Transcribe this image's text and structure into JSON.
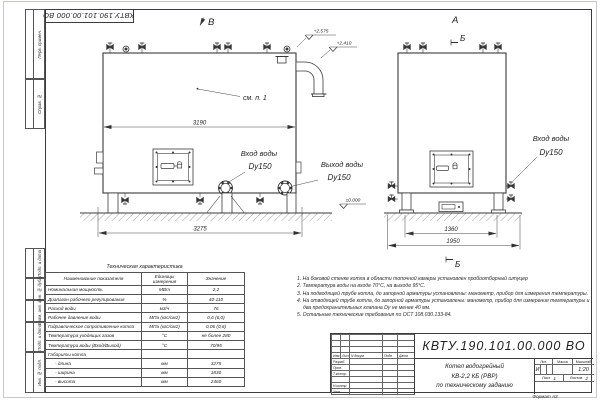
{
  "frame": {
    "top_stamp": "КВТУ.190.101.00.000 ВО",
    "side_labels": [
      "Перв. примен.",
      "Справ. №",
      "Подп. и дата",
      "Инв. № дубл.",
      "Взам. инв. №",
      "Подп. и дата",
      "Инв. № подл."
    ]
  },
  "drawing": {
    "view_b_label": "В",
    "view_a_label": "А",
    "section_label": "Б",
    "callout_see_note": "см. п. 1",
    "dim_3190": "3190",
    "dim_3275": "3275",
    "dim_1360": "1360",
    "dim_1950": "1950",
    "elev_2575": "+2.575",
    "elev_2410": "+2.410",
    "elev_0": "±0.000",
    "inlet_front_label": "Вход воды",
    "inlet_front_size": "Dy150",
    "outlet_front_label": "Выход воды",
    "outlet_front_size": "Dy150",
    "inlet_side_label": "Вход воды",
    "inlet_side_size": "Dy150"
  },
  "tech_table": {
    "title": "Техническая характеристика",
    "headers": [
      "Наименование показателя",
      "Единицы измерения",
      "Значение"
    ],
    "rows": [
      [
        "Номинальная мощность",
        "МВт",
        "2,2"
      ],
      [
        "Диапазон рабочего регулирования",
        "%",
        "40-110"
      ],
      [
        "Расход воды",
        "м3/ч",
        "76"
      ],
      [
        "Рабочее давление воды",
        "МПа (кгс/см2)",
        "0,6 (6,0)"
      ],
      [
        "Гидравлическое сопротивление котла",
        "МПа (кгс/см2)",
        "0,06 (0,6)"
      ],
      [
        "Температура уходящих газов",
        "°С",
        "не более 280"
      ],
      [
        "Температура воды (Вход/Выход)",
        "°С",
        "70/95"
      ],
      [
        "Габариты котла",
        "",
        ""
      ],
      [
        "- длина",
        "мм",
        "3275"
      ],
      [
        "- ширина",
        "мм",
        "1830"
      ],
      [
        "- высота",
        "мм",
        "2460"
      ]
    ]
  },
  "notes": [
    "1.  На боковой стенке котла в области топочной камеры установлен пробоотборный штуцер",
    "2.  Температура воды на входе 70°С, на выходе 95°С.",
    "3.  На подводящей трубе котла, до запорной арматуры установлены: манометр, прибор для измерения температуры.",
    "4.  На отводящей трубе котла, до запорной арматуры установлены: манометр, прибор для измерения температуры и два предохранительных клапана Dу не менее 40 мм.",
    "5.  Остальные технические требования по ОСТ 108.030.133-84."
  ],
  "title_block": {
    "doc_number": "КВТУ.190.101.00.000 ВО",
    "name_line1": "Котел водогрейный",
    "name_line2": "КВ-2,2 КБ (РВР)",
    "name_line3": "по техническому заданию",
    "rev_headers": [
      "Изм.",
      "Лист",
      "N докум",
      "Подп",
      "Дата"
    ],
    "sign_labels": [
      "Разраб.",
      "Пров.",
      "Т.контр.",
      "",
      "Н.контр.",
      "Утв."
    ],
    "lit_header": "Лит.",
    "mass_header": "Масса",
    "scale_header": "Масштаб",
    "lit_value": "И",
    "scale_value": "1:20",
    "sheet_label": "Лист",
    "sheet_value": "1",
    "sheets_label": "Листов",
    "sheets_value": "2",
    "logo_text": "KVZR",
    "logo_sub1": "КОТЕЛЬНЫЙ",
    "logo_sub2": "ЗАВОД РЭП",
    "format_label": "Формат  А3"
  }
}
